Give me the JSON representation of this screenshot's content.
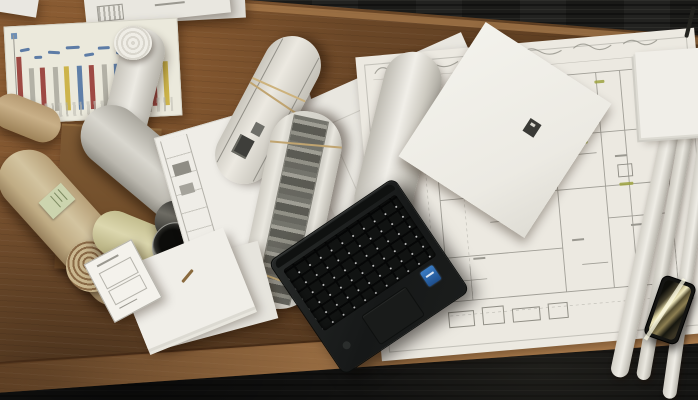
{
  "meta": {
    "type": "photograph",
    "description": "Overhead view of an architect's wooden desk on dark office carpet, covered with rolled-up blueprints, architectural floor plans, loose paper stacks, a black laptop and a smartphone.",
    "width_px": 698,
    "height_px": 400
  },
  "palette": {
    "desk_wood": "#6f4a29",
    "desk_front_edge": "#b98a58",
    "carpet": "#161614",
    "paper": "#edebe3",
    "kraft_roll": "#c9b68e",
    "olive_roll": "#d0ca9e",
    "plan_line": "#a5a39b",
    "highlight_green": "#9ea23f",
    "chart_stripe_yellow": "#cdb44a",
    "chart_stripe_red": "#9e4a44",
    "chart_stripe_blue": "#5f7fa8",
    "chart_stripe_gray": "#b3b1a6",
    "laptop_body": "#1c1e1d",
    "intel_sticker_blue": "#2e6fb8",
    "phone_screen_reflection": "#e6dca6"
  },
  "objects": {
    "carpet": {
      "label": "dark gray office carpet floor"
    },
    "desk": {
      "label": "brown wooden desk surface seen from above"
    },
    "overhang_papers": {
      "label": "loose report pages overhanging the top edge of the desk"
    },
    "schedule_sheet": {
      "label": "project schedule sheet with yellow, red, blue and gray column stripes and blue handwritten notes"
    },
    "cardboard_box": {
      "label": "flat cardboard box under the roll pile"
    },
    "kraft_roll": {
      "label": "large kraft-paper blueprint roll with spiral end and green label sticker"
    },
    "gray_roll": {
      "label": "large gray rolled drawing"
    },
    "olive_roll": {
      "label": "olive-green rolled drawing"
    },
    "film_roll": {
      "label": "dark glossy film roll with black spiral core"
    },
    "white_roll_small": {
      "label": "small white rolled drawing"
    },
    "white_roll_upper": {
      "label": "white rolled drawing over the schedule sheet"
    },
    "titleblock_sheet": {
      "label": "drawing sheet with left title block, logo stamps and small plan print"
    },
    "camera_print_roll": {
      "label": "rolled print sheet with dark photo block and rubber bands"
    },
    "elevation_print_roll": {
      "label": "rolled sheet with dark elevation print stripe"
    },
    "under_laptop_sheet": {
      "label": "white drawing sheet with faint lines and small label box"
    },
    "white_roll_vertical": {
      "label": "white rolled sheet lying beside the floor plan"
    },
    "floor_plan": {
      "label": "large construction floor plan with pencil mark-ups and green highlighter notes"
    },
    "plan_corner_stack": {
      "label": "stacked sheet corners at top right of the plan"
    },
    "plan_curled_edges": {
      "label": "curled rolled edges of plan sheets at the right"
    },
    "blank_sheet": {
      "label": "blank sheet with small black stamp lying on the plan"
    },
    "paper_stack": {
      "label": "stack of loose white papers at the bottom left"
    },
    "form_card": {
      "label": "small printed form card"
    },
    "pencil": {
      "label": "small pencil stub beside the paper stack"
    },
    "laptop": {
      "label": "black laptop base with keyboard, trackpad and blue intel sticker"
    },
    "smartphone": {
      "label": "smartphone with light reflections on its screen near the desk edge"
    },
    "pen_top_right": {
      "label": "thin dark pen at the top right corner"
    }
  }
}
